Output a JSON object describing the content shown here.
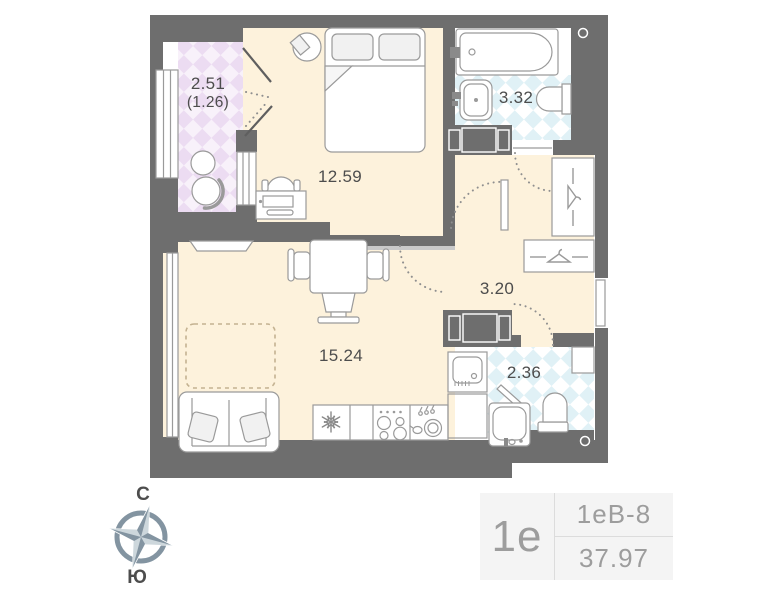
{
  "plan": {
    "rooms": {
      "balcony": {
        "area": "2.51",
        "area_secondary": "(1.26)"
      },
      "bedroom": {
        "area": "12.59"
      },
      "bathroom": {
        "area": "3.32"
      },
      "hallway": {
        "area": "3.20"
      },
      "living_kitchen": {
        "area": "15.24"
      },
      "wc": {
        "area": "2.36"
      }
    }
  },
  "compass": {
    "north": "С",
    "south": "Ю"
  },
  "info_panel": {
    "unit_type": "1е",
    "unit_code": "1еВ-8",
    "total_area": "37.97"
  },
  "colors": {
    "wall": "#6e6e6e",
    "floor": "#fdf2dc",
    "balcony_tile": "#ecdcf2",
    "bath_tile": "#e0f1f6",
    "compass": "#8394a1",
    "panel_bg": "#f4f4f4",
    "panel_text": "#9d9d9d",
    "label_text": "#4d4d4d"
  }
}
